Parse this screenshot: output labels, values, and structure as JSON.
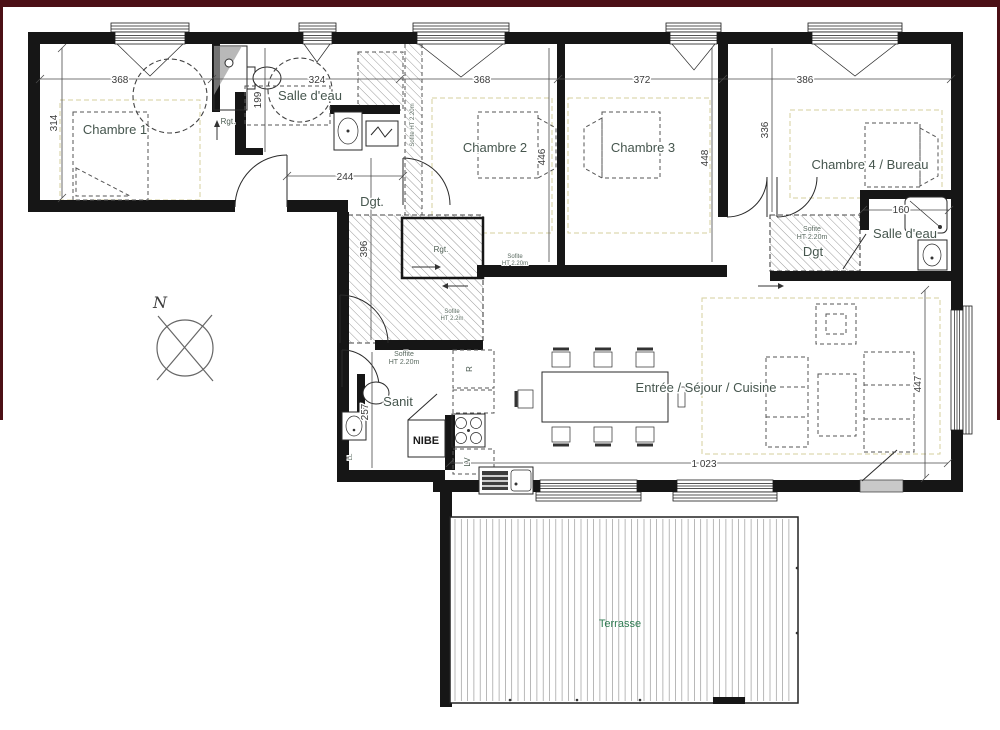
{
  "rooms": {
    "chambre1": "Chambre 1",
    "salle_eau1": "Salle d'eau",
    "chambre2": "Chambre 2",
    "chambre3": "Chambre 3",
    "chambre4": "Chambre 4 / Bureau",
    "salle_eau2": "Salle d'eau",
    "dgt1": "Dgt.",
    "dgt2": "Dgt",
    "sanit": "Sanit",
    "sejour": "Entrée / Séjour / Cuisine",
    "terrasse": "Terrasse"
  },
  "dimensions": {
    "top_368a": "368",
    "top_324": "324",
    "top_368b": "368",
    "top_372": "372",
    "top_386": "386",
    "left_314": "314",
    "sde1_199": "199",
    "hall_244": "244",
    "ch2_446": "446",
    "ch3_448": "448",
    "ch4_336": "336",
    "hall_396": "396",
    "sanit_257": "257",
    "sde2_160": "160",
    "living_447": "447",
    "living_1023": "1 023"
  },
  "annotations": {
    "north": "N",
    "rgt1": "Rgt.",
    "rgt2": "Rgt.",
    "nibe": "NIBE",
    "fridge": "R",
    "dishwasher": "LV",
    "laundry": "LL",
    "soffit_strip": "Sofite HT 2.20m",
    "soffit_hall_l1": "Sofite",
    "soffit_hall_l2": "HT 2.2m",
    "soffit_ch2_l1": "Sofite",
    "soffit_ch2_l2": "HT 2.20m",
    "soffit_sanit_l1": "Soffite",
    "soffit_sanit_l2": "HT 2.20m",
    "soffit_dgt2_l1": "Sofite",
    "soffit_dgt2_l2": "HT 2.20m"
  },
  "colors": {
    "frame": "#4c1016",
    "wall": "#161616",
    "room_label": "#46564e",
    "dimension_label": "#3a3a3a",
    "terrace_label": "#2f7b52",
    "hatch": "#9a9a9a",
    "pale_guide": "#d6cf9e"
  }
}
